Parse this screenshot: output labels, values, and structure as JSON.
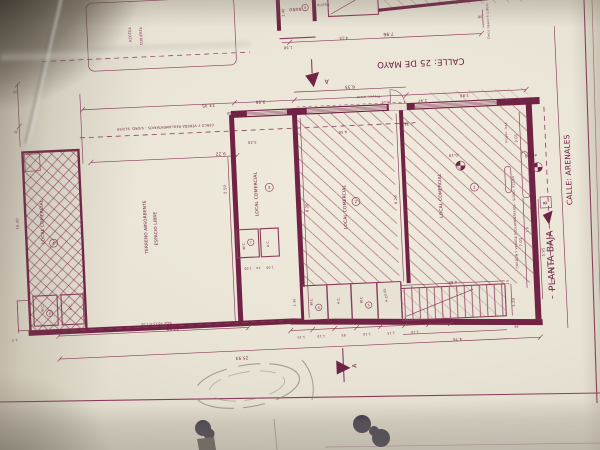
{
  "colors": {
    "ink": "#702344",
    "ink_thin": "#8a3c5a",
    "paper": "#e7e2d4",
    "blob_ink": "#221e30"
  },
  "plan": {
    "title": "PLANTA BAJA",
    "streets": {
      "top": "CALLE: 25 DE MAYO",
      "right": "CALLE: ARENALES"
    },
    "locals": [
      {
        "label": "LOCAL COMERCIAL",
        "num": "1"
      },
      {
        "label": "LOCAL COMERCIAL",
        "num": "2"
      },
      {
        "label": "LOCAL COMERCIAL",
        "num": "3"
      },
      {
        "label": "LOCAL COMERCIAL",
        "num": "4"
      }
    ],
    "open_area": {
      "line1": "TERRENO ABSORBENTE",
      "line2": "ESPACIO LIBRE"
    },
    "rooms": {
      "wc": "W.C.",
      "ac": "A.C."
    },
    "room_nums": {
      "wc5": "5",
      "wc6": "6",
      "wc7": "7",
      "wc8": "8"
    },
    "upper": {
      "bath": "BAÑO",
      "bath_num": "9",
      "hall": "Pasillo",
      "roof_a": "AZOTEA",
      "roof_b": "CUBIERTA"
    },
    "levels": [
      "-0.10",
      "±0.00"
    ],
    "sections": {
      "a": "A",
      "b": "B"
    },
    "texts": [
      {
        "t": "7.96",
        "x": 397,
        "y": 37,
        "r": 180,
        "s": 4.4
      },
      {
        "t": ".30",
        "x": 490,
        "y": 24,
        "r": 180,
        "s": 3.4
      },
      {
        "t": "1.50",
        "x": 296,
        "y": 46,
        "r": 180,
        "s": 3.6
      },
      {
        "t": "4.15",
        "x": 352,
        "y": 39,
        "r": 180,
        "s": 3.6
      },
      {
        "t": "2.40",
        "x": 294,
        "y": 12,
        "r": -90,
        "s": 3.4
      },
      {
        "t": "23.35",
        "x": 214,
        "y": 100,
        "r": 180,
        "s": 4.2
      },
      {
        "t": "3.95",
        "x": 266,
        "y": 99,
        "r": 180,
        "s": 4.2
      },
      {
        "t": "6.35",
        "x": 356,
        "y": 88,
        "r": 180,
        "s": 4.2
      },
      {
        "t": "0.15",
        "x": 391,
        "y": 105,
        "r": 180,
        "s": 3.4
      },
      {
        "t": "2.47",
        "x": 428,
        "y": 105,
        "r": 180,
        "s": 3.6
      },
      {
        "t": "2.89",
        "x": 470,
        "y": 102,
        "r": 180,
        "s": 3.6
      },
      {
        "t": "2.34",
        "x": 413,
        "y": 128,
        "r": 180,
        "s": 3.6
      },
      {
        "t": "4.30",
        "x": 347,
        "y": 133,
        "r": 180,
        "s": 3.6
      },
      {
        "t": "9.22",
        "x": 224,
        "y": 149,
        "r": 180,
        "s": 4.2
      },
      {
        "t": "3.20",
        "x": 256,
        "y": 139,
        "r": 180,
        "s": 3.6
      },
      {
        "t": "1.00",
        "x": 236,
        "y": 109,
        "r": 180,
        "s": 3.4
      },
      {
        "t": "5.50",
        "x": 228,
        "y": 186,
        "r": -90,
        "s": 3.6
      },
      {
        "t": "8.20",
        "x": 309,
        "y": 208,
        "r": -90,
        "s": 3.6
      },
      {
        "t": "6.20",
        "x": 398,
        "y": 204,
        "r": -90,
        "s": 3.6
      },
      {
        "t": "3.01",
        "x": 521,
        "y": 148,
        "r": -90,
        "s": 3.6
      },
      {
        "t": "7.01",
        "x": 521,
        "y": 252,
        "r": -90,
        "s": 3.6
      },
      {
        "t": "7.0",
        "x": 528,
        "y": 240,
        "r": -90,
        "s": 3.2
      },
      {
        "t": "5.95",
        "x": 543,
        "y": 263,
        "r": -90,
        "s": 3.6
      },
      {
        "t": "12.56",
        "x": 168,
        "y": 322,
        "r": 180,
        "s": 4.2
      },
      {
        "t": "25.93",
        "x": 236,
        "y": 354,
        "r": 180,
        "s": 4.2
      },
      {
        "t": "4.86",
        "x": 450,
        "y": 288,
        "r": 180,
        "s": 3.6
      },
      {
        "t": "4.76",
        "x": 452,
        "y": 345,
        "r": 180,
        "s": 3.6
      },
      {
        "t": "1.20",
        "x": 511,
        "y": 312,
        "r": -90,
        "s": 3.6
      },
      {
        "t": ".15",
        "x": 506,
        "y": 292,
        "r": -90,
        "s": 3.2
      },
      {
        "t": ".95",
        "x": 512,
        "y": 335,
        "r": 180,
        "s": 3.2
      },
      {
        "t": "1.15",
        "x": 296,
        "y": 336,
        "r": 180,
        "s": 3.2
      },
      {
        "t": "1.10",
        "x": 316,
        "y": 336,
        "r": 180,
        "s": 3.2
      },
      {
        "t": ".95",
        "x": 339,
        "y": 336,
        "r": 180,
        "s": 3.2
      },
      {
        "t": "1.10",
        "x": 362,
        "y": 336,
        "r": 180,
        "s": 3.2
      },
      {
        "t": "1.15",
        "x": 386,
        "y": 336,
        "r": 180,
        "s": 3.2
      },
      {
        "t": "1.10",
        "x": 410,
        "y": 336,
        "r": 180,
        "s": 3.2
      },
      {
        "t": "1.00",
        "x": 246,
        "y": 265,
        "r": 180,
        "s": 3.0
      },
      {
        "t": ".10",
        "x": 257,
        "y": 265,
        "r": 180,
        "s": 3.0
      },
      {
        "t": "1.00",
        "x": 268,
        "y": 265,
        "r": 180,
        "s": 3.0
      },
      {
        "t": "3.05",
        "x": 383,
        "y": 296,
        "r": -90,
        "s": 3.2
      },
      {
        "t": "1.30",
        "x": 292,
        "y": 302,
        "r": -90,
        "s": 3.2
      },
      {
        "t": "16.30",
        "x": 19,
        "y": 211,
        "r": -90,
        "s": 3.6
      },
      {
        "t": "1.3",
        "x": 10,
        "y": 326,
        "r": 180,
        "s": 3.2
      },
      {
        "t": ".35",
        "x": 22,
        "y": 78,
        "r": 180,
        "s": 3.2
      },
      {
        "t": ".35",
        "x": 21,
        "y": 118,
        "r": 180,
        "s": 3.2
      },
      {
        "t": "CERCO Y VEREDA REGLAMENTARIOS - S/ORD. 912/69",
        "x": 170,
        "y": 120,
        "r": 180,
        "s": 3.3
      },
      {
        "t": "CORDON Y VEREDA REGLAMENTARIOS - S/ORD. 912/69",
        "x": 516,
        "y": 232,
        "r": -90,
        "s": 3.0
      },
      {
        "t": "Proyec. alero",
        "x": 374,
        "y": 99,
        "r": 180,
        "s": 3.2
      },
      {
        "t": "Proyec. losa",
        "x": 511,
        "y": 142,
        "r": -90,
        "s": 3.0
      },
      {
        "t": "Proyec. losa",
        "x": 534,
        "y": 279,
        "r": -90,
        "s": 3.0
      },
      {
        "t": "Cerco opaco h:1.80m",
        "x": 498,
        "y": 30,
        "r": -90,
        "s": 3.0
      },
      {
        "t": "Reja +0.15 h:2.00",
        "x": 152,
        "y": 316,
        "r": 180,
        "s": 3.0
      }
    ]
  }
}
